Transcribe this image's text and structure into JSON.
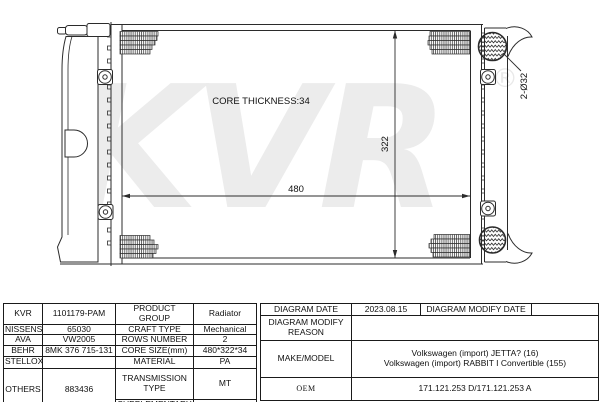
{
  "drawing": {
    "core_thickness_label": "CORE THICKNESS:34",
    "width_dim": "480",
    "height_dim": "322",
    "port_dim": "2-Ø32",
    "watermark": "KVR",
    "watermark_reg": "®",
    "watermark_color": "#ececec",
    "line_color": "#2b2b2b"
  },
  "spec_table": {
    "brands": [
      {
        "name": "KVR",
        "value": "1101179-PAM"
      },
      {
        "name": "NISSENS",
        "value": "65030"
      },
      {
        "name": "AVA",
        "value": "VW2005"
      },
      {
        "name": "BEHR",
        "value": "8MK 376 715-131"
      },
      {
        "name": "STELLOX",
        "value": ""
      },
      {
        "name": "OTHERS",
        "value": "883436"
      }
    ],
    "attributes": [
      {
        "label": "PRODUCT GROUP",
        "value": "Radiator"
      },
      {
        "label": "CRAFT TYPE",
        "value": "Mechanical"
      },
      {
        "label": "ROWS NUMBER",
        "value": "2"
      },
      {
        "label": "CORE SIZE(mm)",
        "value": "480*322*34"
      },
      {
        "label": "MATERIAL",
        "value": "PA"
      },
      {
        "label": "TRANSMISSION TYPE",
        "value": "MT"
      },
      {
        "label": "SUPPLEMENTARY",
        "value": ""
      }
    ]
  },
  "info_table": {
    "diagram_date_label": "DIAGRAM DATE",
    "diagram_date": "2023.08.15",
    "diagram_modify_date_label": "DIAGRAM MODIFY DATE",
    "diagram_modify_date": "",
    "diagram_modify_reason_label": "DIAGRAM MODIFY REASON",
    "diagram_modify_reason": "",
    "make_model_label": "MAKE/MODEL",
    "make_model": [
      "Volkswagen (import) JETTA? (16)",
      "Volkswagen (import) RABBIT I Convertible (155)"
    ],
    "oem_label": "OEM",
    "oem": "171.121.253 D/171.121.253 A"
  }
}
